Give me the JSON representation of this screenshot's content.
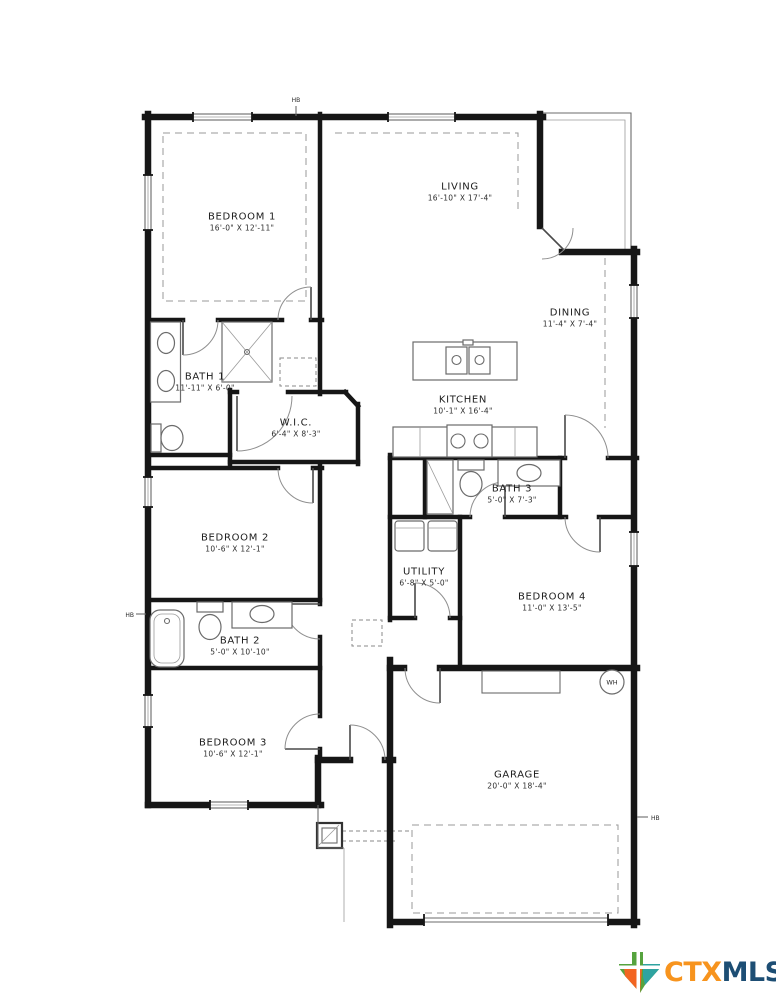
{
  "plan": {
    "rooms": {
      "living": {
        "name": "LIVING",
        "dims": "16'-10\" X 17'-4\""
      },
      "bedroom1": {
        "name": "BEDROOM 1",
        "dims": "16'-0\" X 12'-11\""
      },
      "bath1": {
        "name": "BATH 1",
        "dims": "11'-11\" X 6'-0\""
      },
      "wic": {
        "name": "W.I.C.",
        "dims": "6'-4\" X 8'-3\""
      },
      "dining": {
        "name": "DINING",
        "dims": "11'-4\" X 7'-4\""
      },
      "kitchen": {
        "name": "KITCHEN",
        "dims": "10'-1\" X 16'-4\""
      },
      "bath3": {
        "name": "BATH 3",
        "dims": "5'-0\" X 7'-3\""
      },
      "bedroom2": {
        "name": "BEDROOM 2",
        "dims": "10'-6\" X 12'-1\""
      },
      "utility": {
        "name": "UTILITY",
        "dims": "6'-8\" X 5'-0\""
      },
      "bedroom4": {
        "name": "BEDROOM 4",
        "dims": "11'-0\" X 13'-5\""
      },
      "bath2": {
        "name": "BATH 2",
        "dims": "5'-0\" X 10'-10\""
      },
      "bedroom3": {
        "name": "BEDROOM 3",
        "dims": "10'-6\" X 12'-1\""
      },
      "garage": {
        "name": "GARAGE",
        "dims": "20'-0\" X 18'-4\""
      }
    },
    "markers": {
      "hose_bib": "HB",
      "water_heater": "WH"
    }
  },
  "branding": {
    "ctx": "CTX",
    "mls": "MLS",
    "ctx_color": "#F7941E",
    "mls_color": "#1D4E74",
    "texas_green": "#56A33E",
    "texas_teal": "#2FA3A0",
    "texas_orange": "#F26522"
  }
}
